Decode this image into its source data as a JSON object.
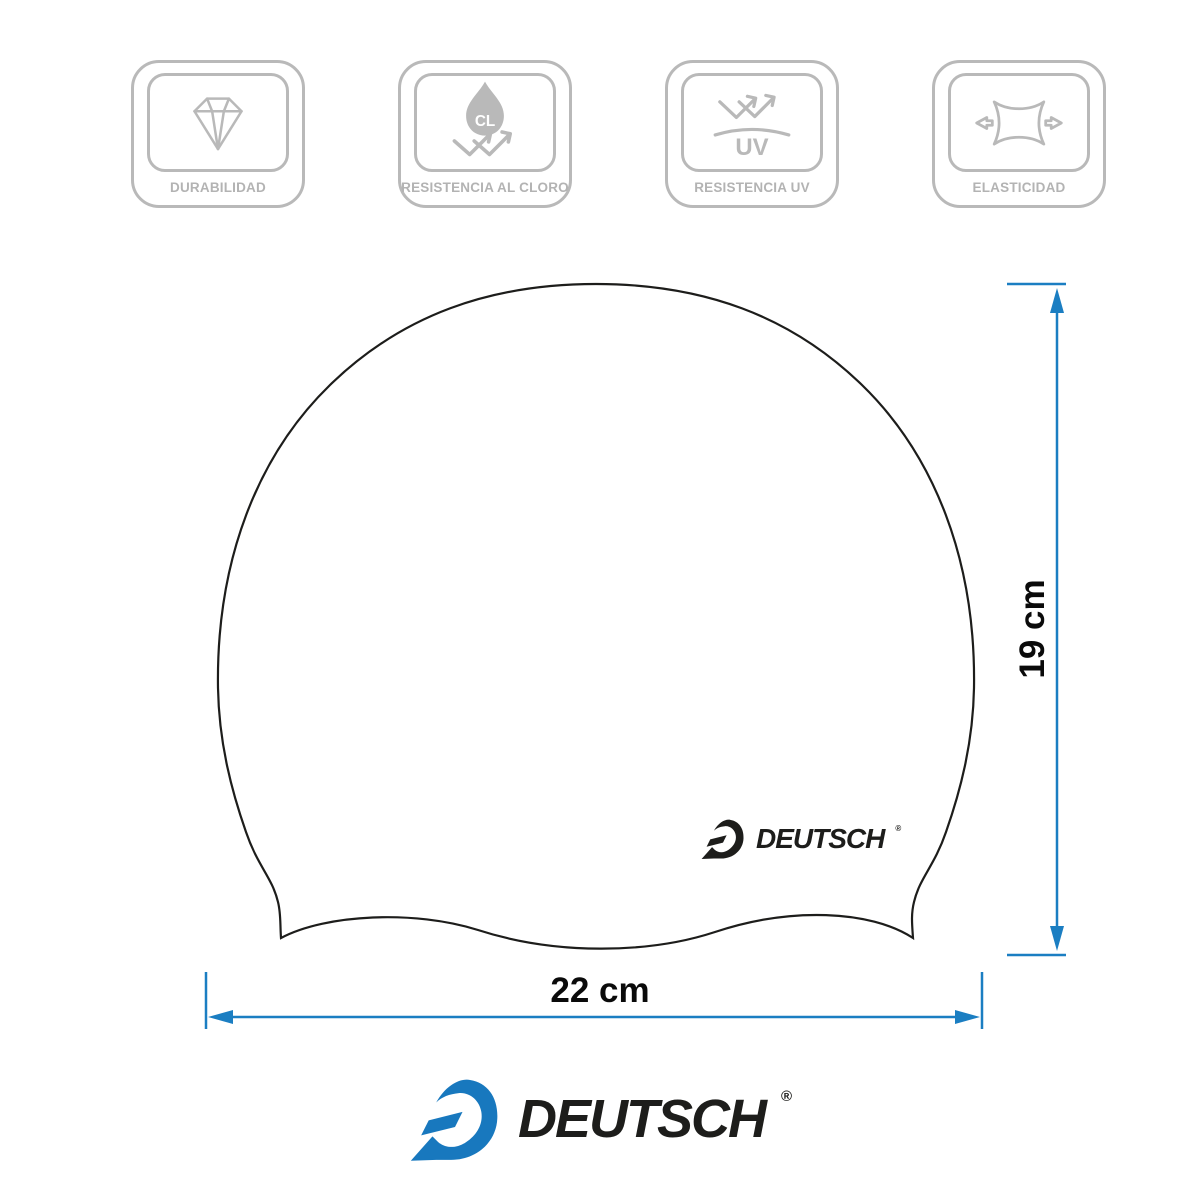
{
  "badges": {
    "color": "#b9b9b9",
    "label_color": "#b3b3b3",
    "items": [
      {
        "label": "DURABILIDAD",
        "icon": "diamond-icon"
      },
      {
        "label": "RESISTENCIA AL CLORO",
        "icon": "chlorine-drop-icon",
        "drop_text": "CL"
      },
      {
        "label": "RESISTENCIA UV",
        "icon": "uv-bounce-icon",
        "surface_text": "UV"
      },
      {
        "label": "ELASTICIDAD",
        "icon": "elasticity-stretch-icon"
      }
    ]
  },
  "cap": {
    "outline_color": "#1d1d1b",
    "fill_color": "#ffffff",
    "logo": {
      "text": "DEUTSCH",
      "registered": "®",
      "color": "#1d1d1b"
    }
  },
  "dimensions": {
    "line_color": "#1b7ec2",
    "text_color": "#0a0a0a",
    "height": {
      "label": "19 cm"
    },
    "width": {
      "label": "22 cm"
    }
  },
  "footer": {
    "logo": {
      "text": "DEUTSCH",
      "registered": "®",
      "mark_color": "#1878be",
      "text_color": "#1d1d1b"
    }
  }
}
